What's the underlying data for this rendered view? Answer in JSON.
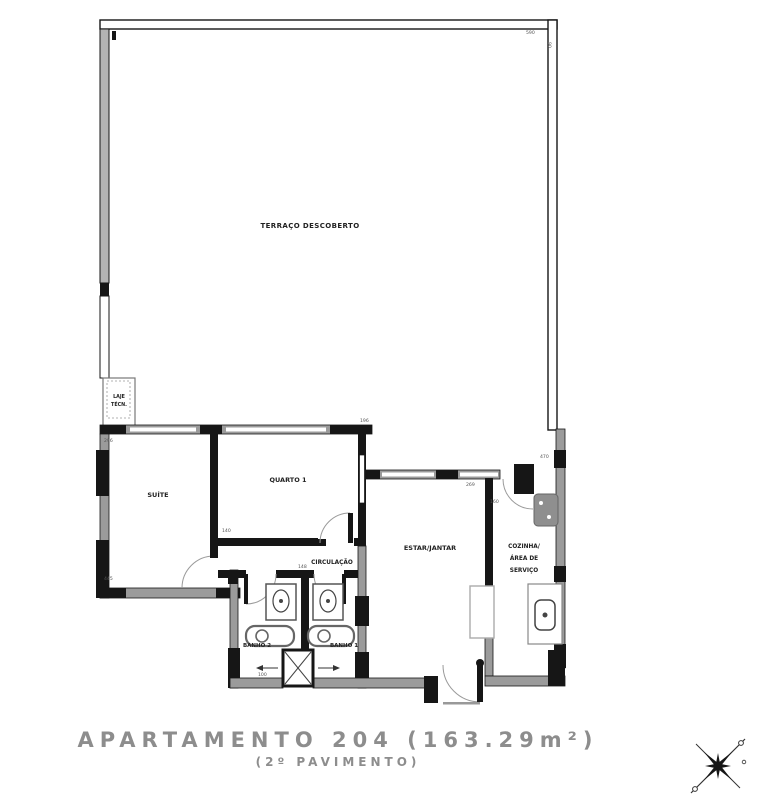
{
  "title": {
    "line1": "APARTAMENTO 204 (163.29m²)",
    "line2": "(2º PAVIMENTO)"
  },
  "rooms": {
    "terrace": "TERRAÇO DESCOBERTO",
    "laje_line1": "LAJE",
    "laje_line2": "TÉCN.",
    "suite": "SUÍTE",
    "quarto1": "QUARTO 1",
    "circulacao": "CIRCULAÇÃO",
    "estar": "ESTAR/JANTAR",
    "cozinha_line1": "COZINHA/",
    "cozinha_line2": "ÁREA DE",
    "cozinha_line3": "SERVIÇO",
    "banho1": "BANHO 1",
    "banho2": "BANHO 2"
  },
  "dimensions": {
    "d1": "296",
    "d2": "196",
    "d3": "140",
    "d4": "269",
    "d5": "160",
    "d6": "470",
    "d7": "100",
    "d8": "445",
    "d9": "148",
    "d10": "590",
    "d11": "90"
  },
  "colors": {
    "wall_black": "#161616",
    "wall_gray": "#9b9b9b",
    "label": "#222222",
    "dim": "#555555",
    "title": "#8d8d8d",
    "background": "#ffffff"
  }
}
